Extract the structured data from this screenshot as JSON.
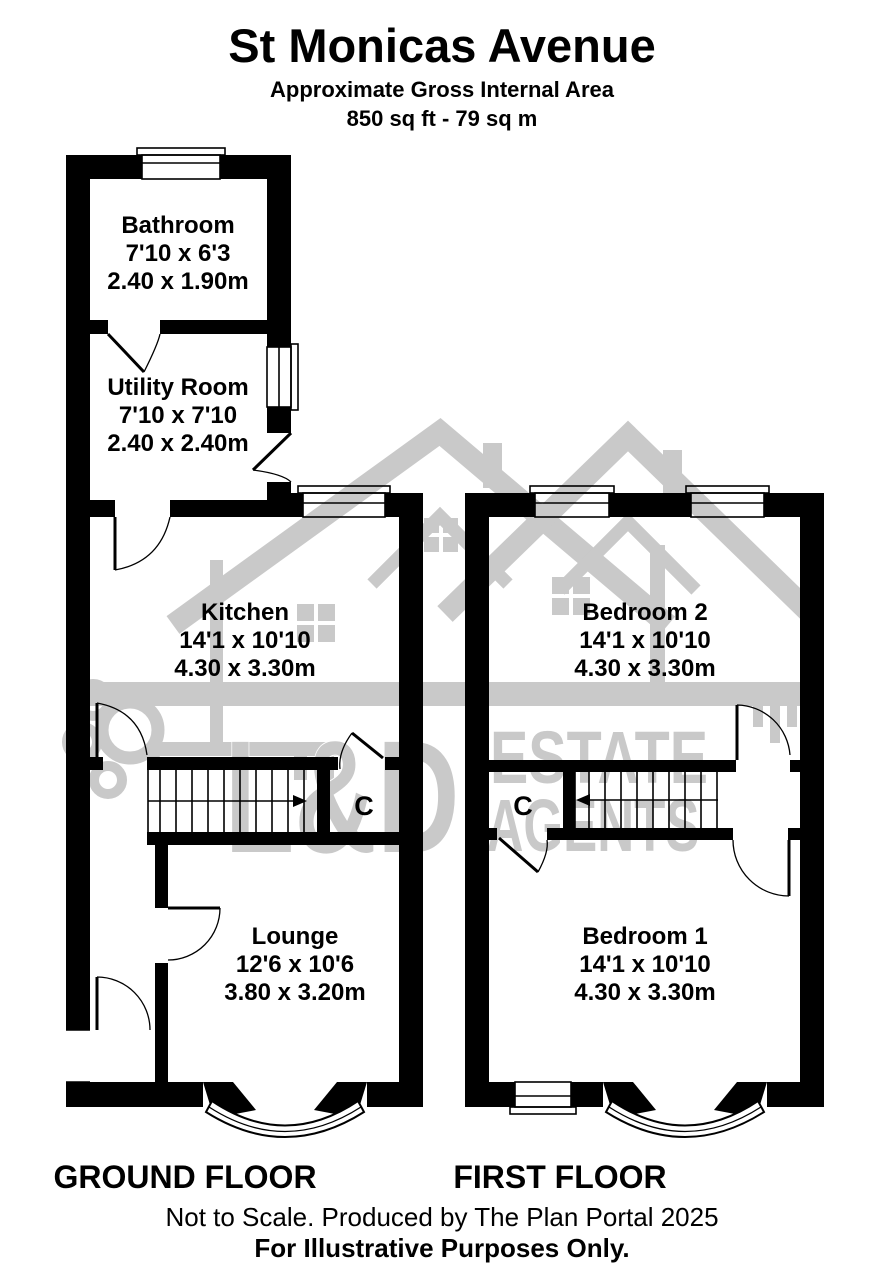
{
  "header": {
    "title": "St Monicas Avenue",
    "subtitle": "Approximate Gross Internal Area",
    "area_line": "850 sq ft - 79 sq m"
  },
  "watermark": {
    "brand": "L&D",
    "word1": "ESTATE",
    "word2": "AGENTS",
    "color": "#c9c9c9"
  },
  "ground_floor": {
    "label": "GROUND FLOOR",
    "bathroom": {
      "name": "Bathroom",
      "imperial": "7'10 x 6'3",
      "metric": "2.40 x 1.90m"
    },
    "utility": {
      "name": "Utility Room",
      "imperial": "7'10 x 7'10",
      "metric": "2.40 x 2.40m"
    },
    "kitchen": {
      "name": "Kitchen",
      "imperial": "14'1 x 10'10",
      "metric": "4.30 x 3.30m"
    },
    "lounge": {
      "name": "Lounge",
      "imperial": "12'6 x 10'6",
      "metric": "3.80 x 3.20m"
    },
    "cupboard": "C"
  },
  "first_floor": {
    "label": "FIRST FLOOR",
    "bedroom2": {
      "name": "Bedroom 2",
      "imperial": "14'1 x 10'10",
      "metric": "4.30 x 3.30m"
    },
    "bedroom1": {
      "name": "Bedroom 1",
      "imperial": "14'1 x 10'10",
      "metric": "4.30 x 3.30m"
    },
    "cupboard": "C"
  },
  "footer": {
    "line1": "Not to Scale. Produced by The Plan Portal 2025",
    "line2": "For Illustrative Purposes Only."
  },
  "colors": {
    "wall": "#000000",
    "background": "#ffffff",
    "watermark": "#c9c9c9"
  }
}
